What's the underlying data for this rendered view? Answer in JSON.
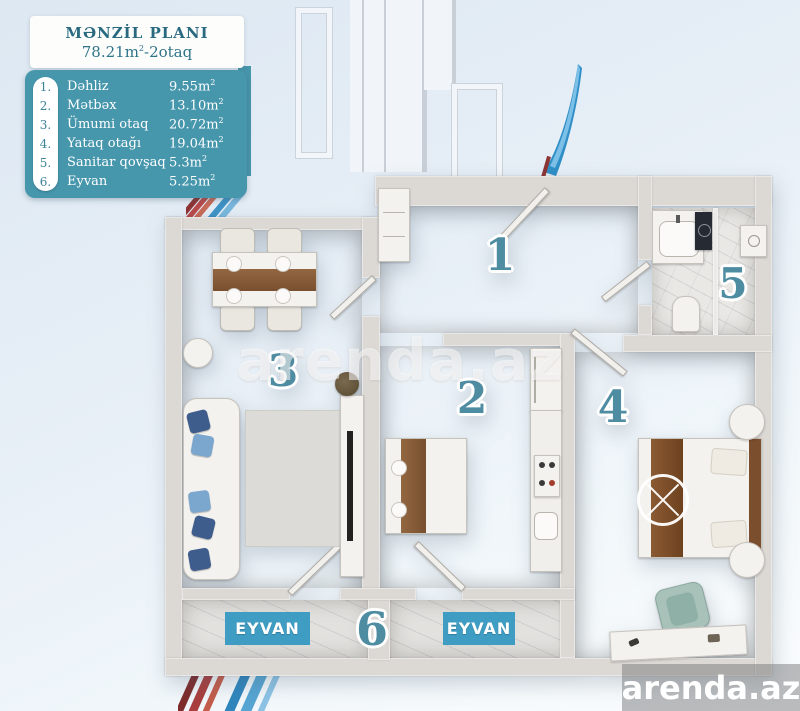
{
  "header": {
    "title": "MƏNZİL PLANI",
    "subtitle_area": "78.21m",
    "subtitle_sup": "2",
    "subtitle_rest": "-2otaq"
  },
  "legend": {
    "items": [
      {
        "num": "1.",
        "name": "Dəhliz",
        "area": "9.55m",
        "sup": "2"
      },
      {
        "num": "2.",
        "name": "Mətbəx",
        "area": "13.10m",
        "sup": "2"
      },
      {
        "num": "3.",
        "name": "Ümumi otaq",
        "area": "20.72m",
        "sup": "2"
      },
      {
        "num": "4.",
        "name": "Yataq otağı",
        "area": "19.04m",
        "sup": "2"
      },
      {
        "num": "5.",
        "name": "Sanitar qovşaq",
        "area": "5.3m",
        "sup": "2"
      },
      {
        "num": "6.",
        "name": "Eyvan",
        "area": "5.25m",
        "sup": "2"
      }
    ]
  },
  "plan": {
    "numbers": {
      "hall": "1",
      "kitchen": "2",
      "living": "3",
      "bedroom": "4",
      "bath": "5",
      "balcony": "6"
    },
    "balcony_left_label": "EYVAN",
    "balcony_right_label": "EYVAN"
  },
  "watermark": "arenda.az",
  "logo": "arenda.az",
  "colors": {
    "panel_teal": "#4696AC",
    "badge_teal": "#3F9DC3",
    "number_teal": "#4E8CA2",
    "title_teal": "#2A6A80",
    "stripe_red": "#A83E3E",
    "stripe_blue": "#3E93C6"
  }
}
